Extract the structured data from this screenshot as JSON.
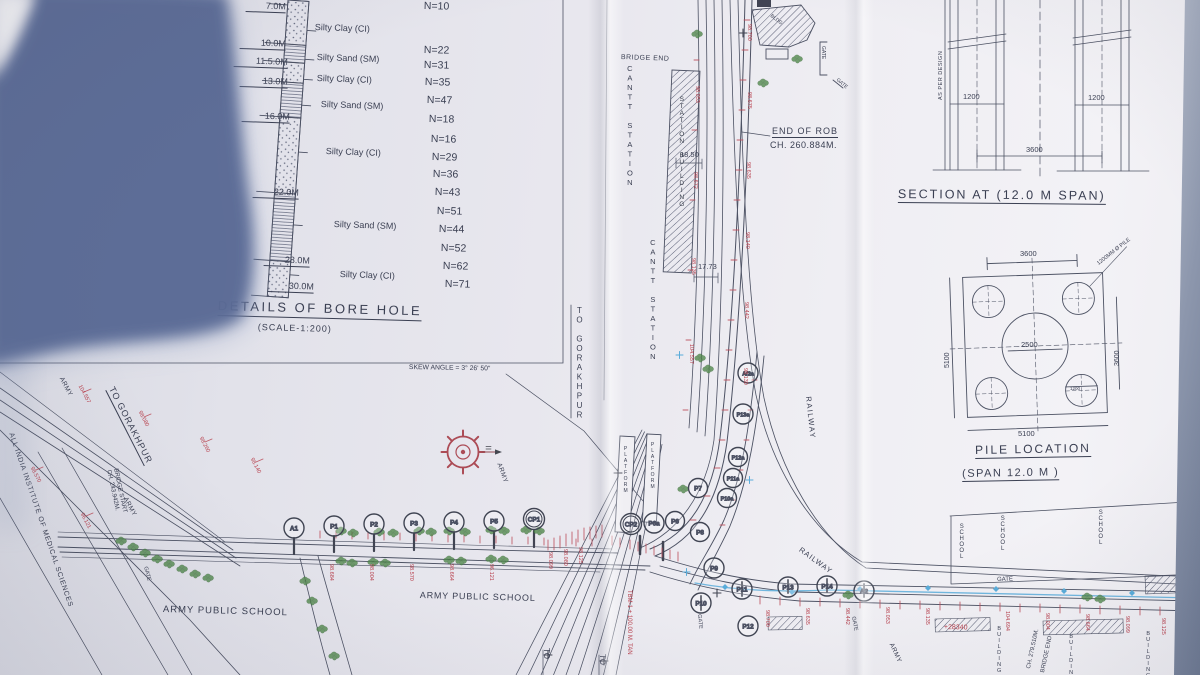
{
  "borehole": {
    "title": "DETAILS OF BORE HOLE",
    "scale_note": "(SCALE-1:200)",
    "depths": [
      "7.0M",
      "10.0M",
      "11.5.0M",
      "13.0M",
      "16.0M",
      "22.0M",
      "28.0M",
      "30.0M"
    ],
    "soils": [
      "Silty Clay (CI)",
      "Silty Sand (SM)",
      "Silty Clay (CI)",
      "Silty Sand (SM)",
      "Silty Clay (CI)",
      "Silty Sand (SM)",
      "Silty Clay (CI)"
    ],
    "n_values": [
      "N=10",
      "N=22",
      "N=31",
      "N=35",
      "N=47",
      "N=18",
      "N=16",
      "N=29",
      "N=36",
      "N=43",
      "N=51",
      "N=44",
      "N=52",
      "N=62",
      "N=71"
    ]
  },
  "section": {
    "title": "SECTION AT  (12.0 M SPAN)",
    "dim_pile_left": "1200",
    "dim_pile_right": "1200",
    "dim_spacing": "3600",
    "note": "AS PER DESIGN"
  },
  "pile_location": {
    "title": "PILE LOCATION",
    "subtitle": "(SPAN   12.0  M )",
    "dim_top": "3600",
    "dim_left": "5100",
    "dim_center": "2500",
    "dim_right": "3600",
    "dim_pile_dia": "1200",
    "dim_bottom": "5100",
    "note": "1200MM Ø PILE"
  },
  "plan": {
    "skew_note": "SKEW ANGLE = 3° 26' 50\"",
    "bridge_end_top": "BRIDGE END",
    "cantt_station": "CANTT STATION",
    "station_building": "STATION BUILDING",
    "to_gorakhpur": "TO GORAKHPUR",
    "end_of_rob_1": "END OF ROB",
    "end_of_rob_2": "CH. 260.884M.",
    "dim_span_1": "18.50",
    "dim_span_2": "17.73",
    "railway": "RAILWAY",
    "platform": "PLATFORM",
    "army": "ARMY",
    "gate": "GATE",
    "bldg": "BLDG",
    "school": "SCHOOL",
    "building": "BUILDING",
    "army_public_school": "ARMY PUBLIC SCHOOL",
    "aiims": "ALL INDIA INSTITUTE OF MEDICAL SCIENCES",
    "bridge_start_1": "BRIDGE START",
    "bridge_start_2": "CH. 243.942M.",
    "bridge_end_ch": "CH. 279.510M.",
    "bridge_end_label": "BRIDGE END",
    "tbm_note": "TBM-1 + 100.00 M. TAN",
    "offset_note": "+28340",
    "to_label": "TO"
  },
  "piers": {
    "main": [
      "A1",
      "P1",
      "P2",
      "P3",
      "P4",
      "P5",
      "CP1"
    ],
    "junction": [
      "CP2",
      "P6a",
      "P6",
      "P7",
      "P8",
      "P9"
    ],
    "ramp": [
      "A/2a",
      "P13a",
      "P12a",
      "P11a",
      "P10a"
    ],
    "east": [
      "P10",
      "P11",
      "P12",
      "P13",
      "P14",
      "A2"
    ]
  },
  "spot_levels": [
    "98.700",
    "98.675",
    "98.635",
    "98.140",
    "98.442",
    "98.130",
    "98.053",
    "98.672",
    "98.135",
    "104.557",
    "104.694",
    "98.684",
    "98.004",
    "98.570",
    "98.664",
    "96.121",
    "98.099",
    "98.080",
    "98.125",
    "98.260"
  ],
  "colors": {
    "ink": "#3a3f52",
    "red": "#b8404d",
    "green": "#3e7d38",
    "water_blue": "#4aa6d8",
    "shadow": "#5f7098",
    "paper": "#ecebf1"
  }
}
